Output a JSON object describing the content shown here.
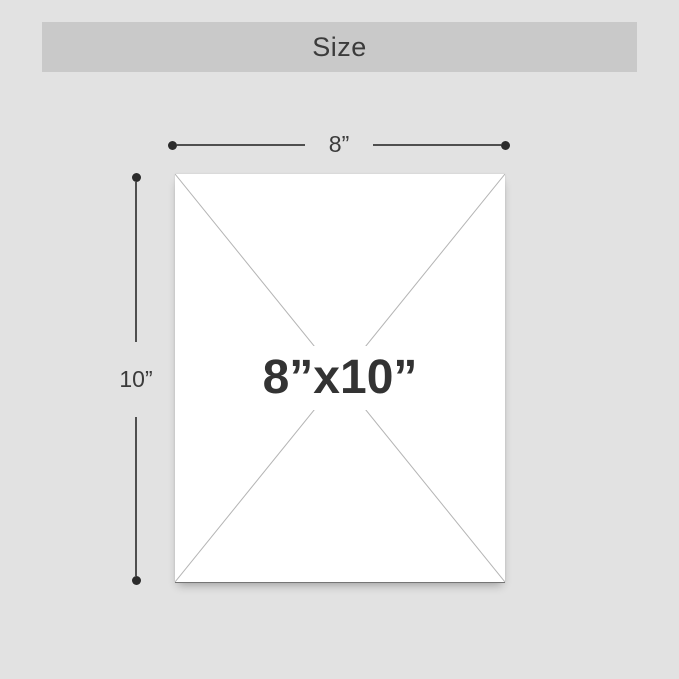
{
  "header": {
    "title": "Size"
  },
  "diagram": {
    "width_dimension": {
      "label": "8”"
    },
    "height_dimension": {
      "label": "10”"
    },
    "panel": {
      "size_label": "8”x10”"
    }
  },
  "colors": {
    "background": "#e2e2e2",
    "banner_background": "#c9c9c9",
    "title_text": "#3b3b3b",
    "panel_fill": "#ffffff",
    "panel_bottom_edge": "#757575",
    "diagonal_line": "#b4b4b4",
    "dimension_line": "#4f4f4f",
    "dimension_dot": "#2b2b2b",
    "size_label_text": "#333333"
  }
}
